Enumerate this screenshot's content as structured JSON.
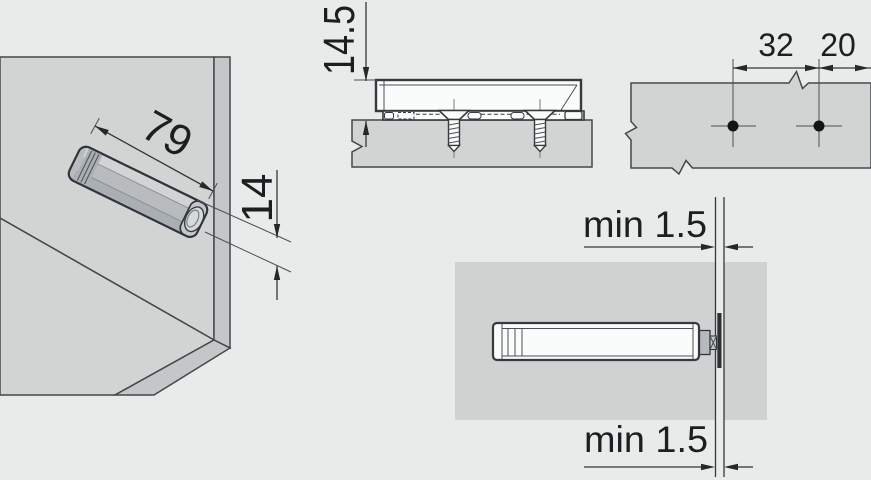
{
  "views": {
    "isometric": {
      "length": "79",
      "height": "14"
    },
    "side_section": {
      "height_above_panel": "14.5"
    },
    "drill_pattern": {
      "hole_pitch": "32",
      "edge_distance": "20"
    },
    "plan": {
      "gap_top": "min 1.5",
      "gap_bottom": "min 1.5"
    }
  },
  "colors": {
    "background": "#e9eaea",
    "panel_fill": "#d2d4d4",
    "panel_edge_fill": "#c3c7c8",
    "device_body": "#b8bcbe",
    "device_top": "#d0d4d5",
    "white_part": "#fafbfb",
    "drawing_line": "#2e3437",
    "dimension_line": "#33383b",
    "text": "#1c1f21",
    "hole_dot": "#141414"
  }
}
